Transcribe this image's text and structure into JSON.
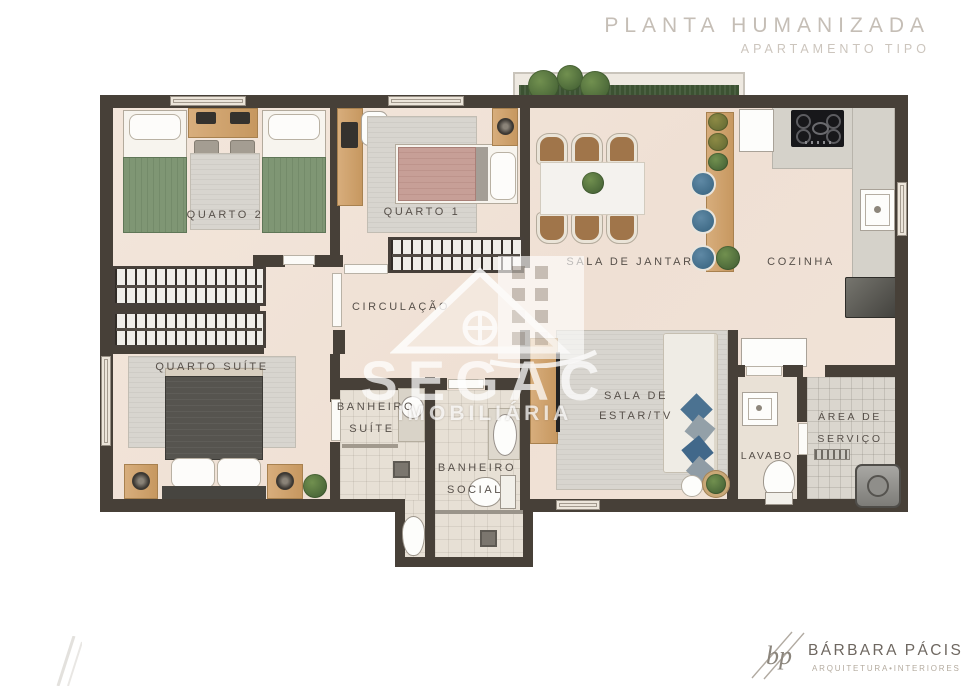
{
  "header": {
    "title": "PLANTA HUMANIZADA",
    "subtitle": "APARTAMENTO TIPO"
  },
  "rooms": {
    "quarto2": {
      "label": "QUARTO 2"
    },
    "quarto1": {
      "label": "QUARTO 1"
    },
    "sala_jantar": {
      "label": "SALA DE JANTAR"
    },
    "cozinha": {
      "label": "COZINHA"
    },
    "circulacao": {
      "label": "CIRCULAÇÃO"
    },
    "quarto_suite": {
      "label": "QUARTO SUÍTE"
    },
    "banheiro_suite": {
      "line1": "BANHEIRO",
      "line2": "SUÍTE"
    },
    "banheiro_social": {
      "line1": "BANHEIRO",
      "line2": "SOCIAL"
    },
    "sala_estar": {
      "line1": "SALA DE",
      "line2": "ESTAR/TV"
    },
    "lavabo": {
      "label": "LAVABO"
    },
    "area_servico": {
      "line1": "ÁREA DE",
      "line2": "SERVIÇO"
    }
  },
  "watermark": {
    "name": "SEGAC",
    "tagline": "IMOBILIÁRIA"
  },
  "footer": {
    "monogram": "bp",
    "name": "BÁRBARA PÁCIS",
    "tagline": "ARQUITETURA•INTERIORES"
  },
  "colors": {
    "wall": "#474038",
    "floor": "#f1e3d8",
    "bathroom_tile": "#e7e0d5",
    "bed_green": "#7f9674",
    "bed_rose": "#c79f97",
    "suite_bed": "#56544f",
    "wood": "#cfa06c",
    "stool_blue": "#416f8e",
    "pillow_blue": "#4b7291",
    "plant_green": "#4e6b3e",
    "title_gray": "#c5beb6",
    "label_gray": "#57504a"
  }
}
